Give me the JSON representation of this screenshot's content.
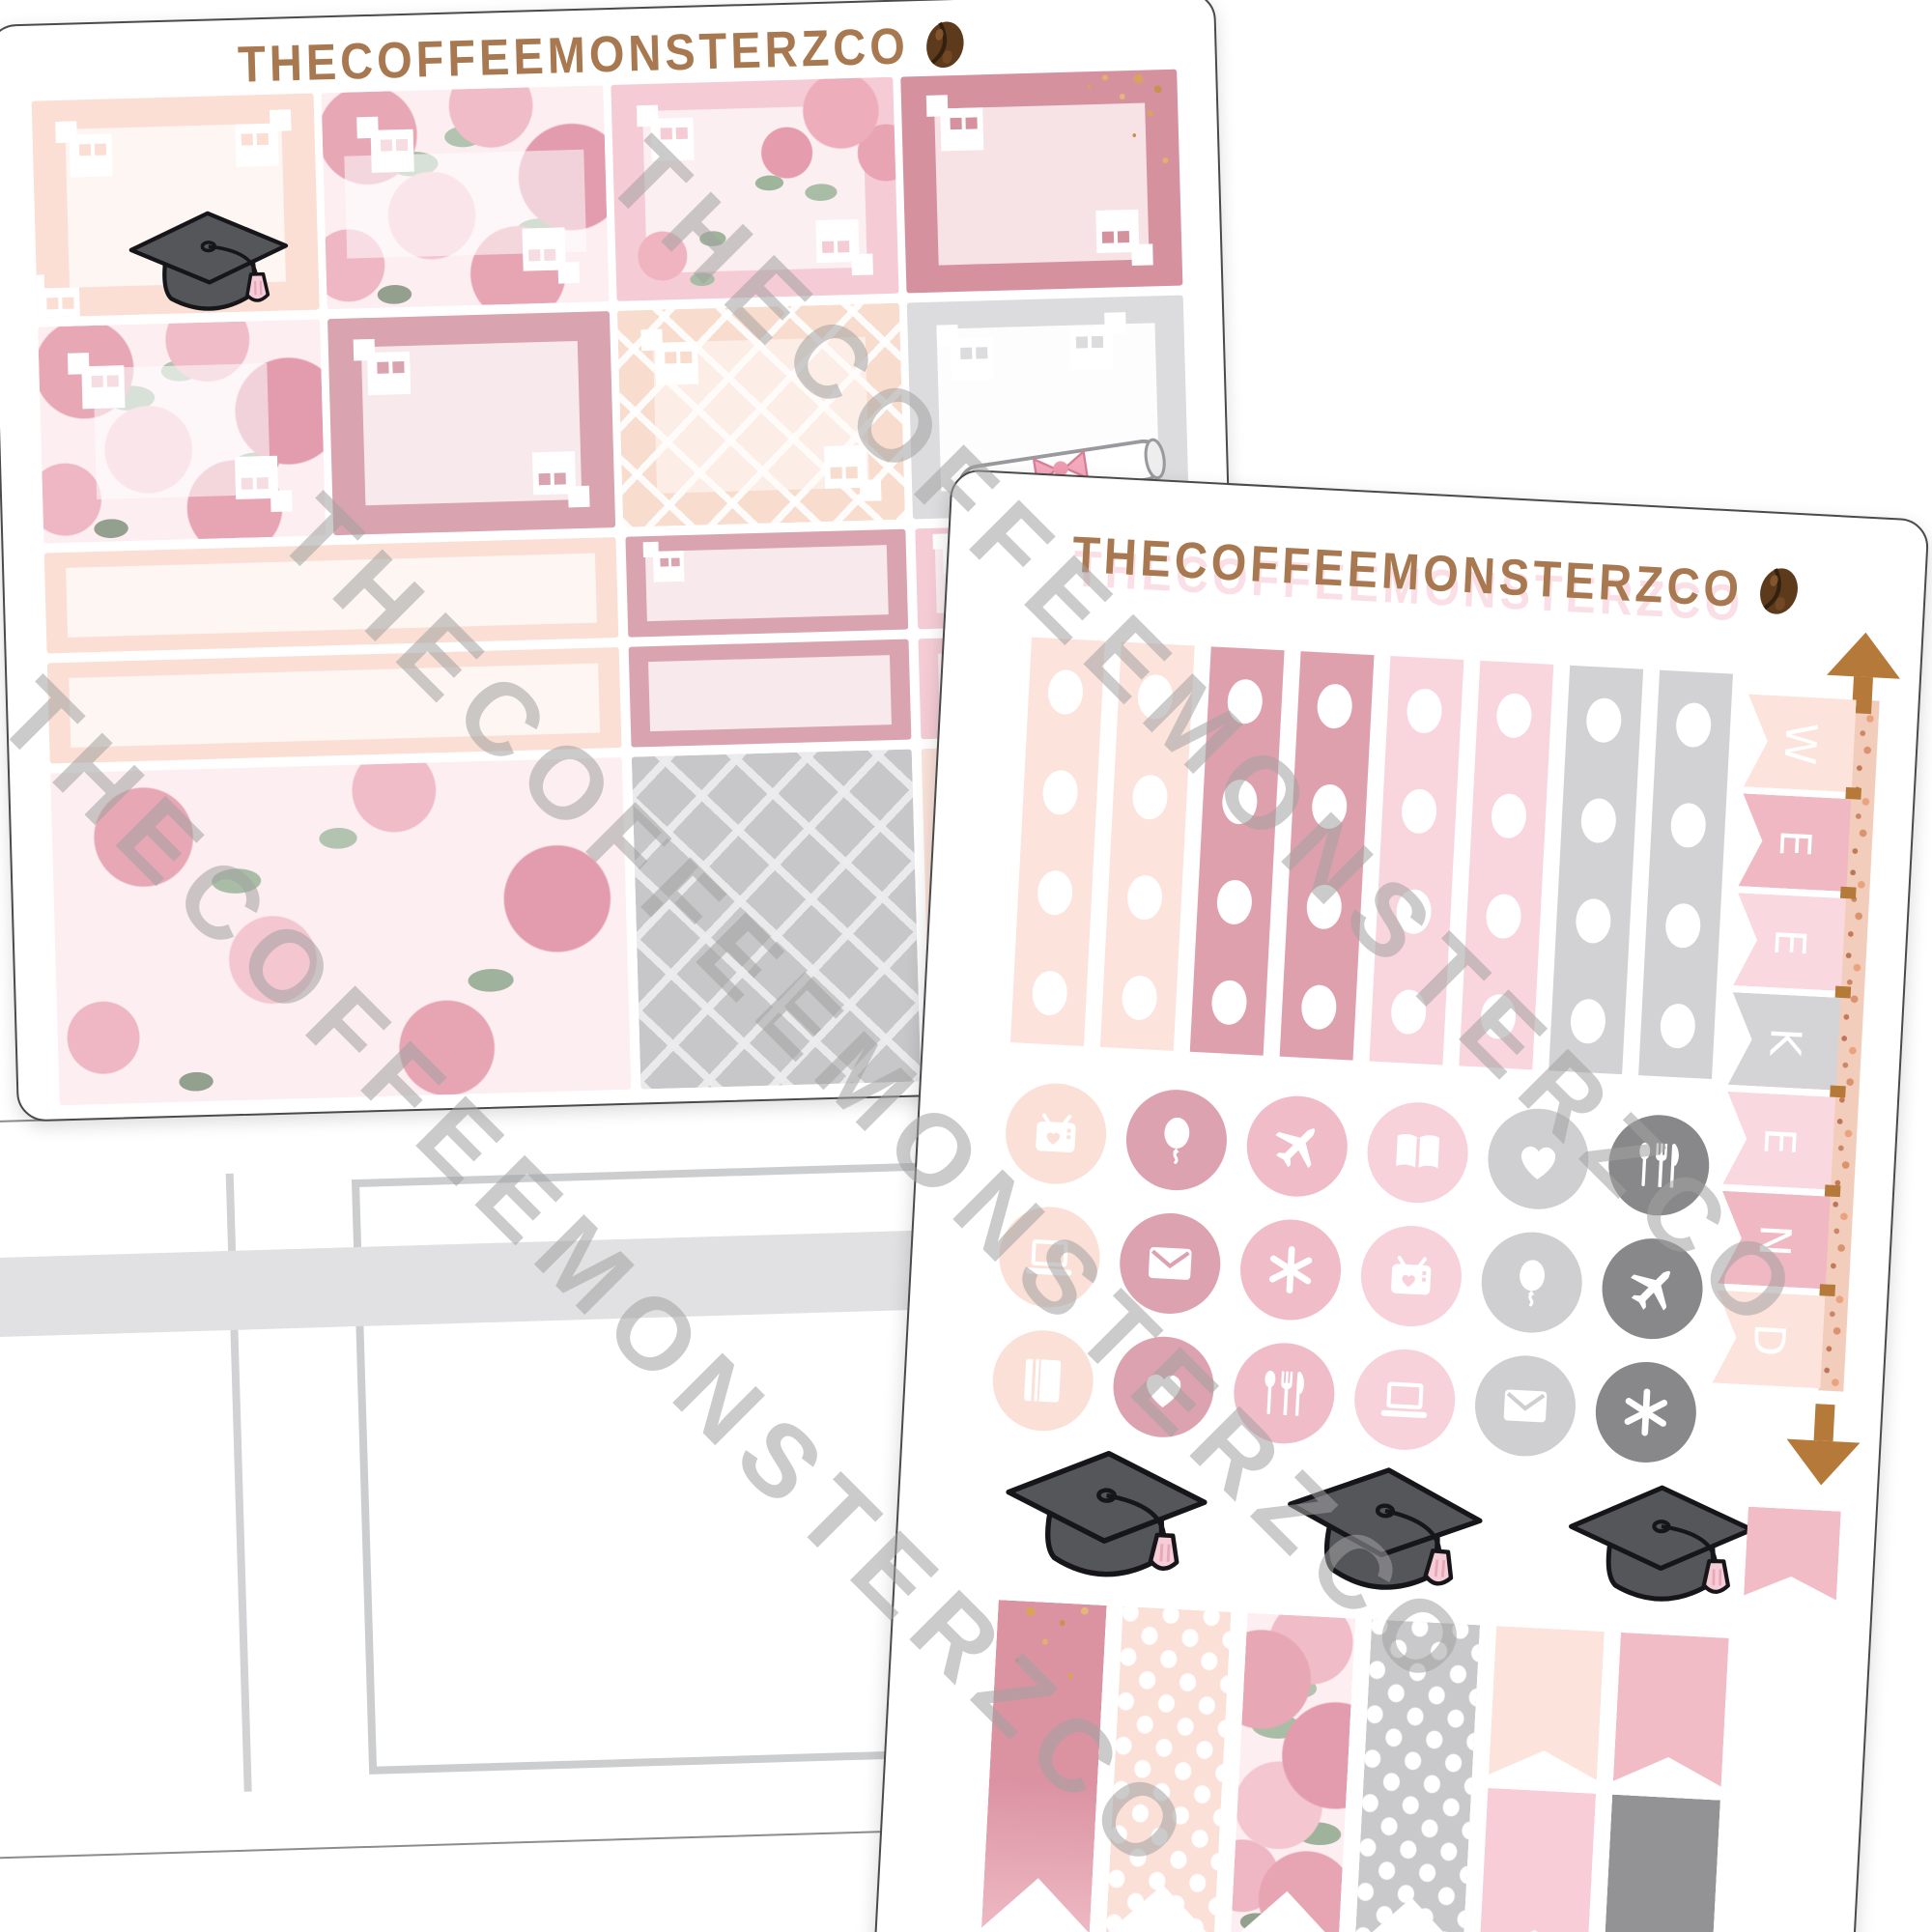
{
  "brand": {
    "name": "THECOFFEEMONSTERZCO",
    "logo_icon": "coffee-bean-icon",
    "text_color": "#a87950"
  },
  "watermark": {
    "text": "THECOFFEEMONSTERZCO",
    "color": "#a2a2a2"
  },
  "back_sheet": {
    "brand": "THECOFFEEMONSTERZCO",
    "theme": "graduation pink floral weekly kit",
    "row1_boxes": [
      "peach-border-box-with-graduation-cap",
      "floral-box-white-band",
      "pink-border-box-corner-roses",
      "rose-glitter-box"
    ],
    "row2_boxes": [
      "floral-box-white-center",
      "rose-border-box",
      "peach-lattice-box",
      "white-gray-box-with-diploma"
    ],
    "quarter_box_columns": [
      "peach-border-wide",
      "rose-border",
      "pink-border"
    ],
    "quarter_box_rows": 2,
    "bottom_boxes": [
      "floral-full-box",
      "gray-lattice-box",
      "peach-plain-box"
    ]
  },
  "front_sheet": {
    "brand": "THECOFFEEMONSTERZCO",
    "checklist_flags": {
      "dot_count": 4,
      "colors": [
        "#fce3dc",
        "#fce3dc",
        "#dfa0ad",
        "#dfa0ad",
        "#f9d6dd",
        "#f9d6dd",
        "#d2d2d4",
        "#d2d2d4"
      ]
    },
    "icon_grid": {
      "column_colors": [
        "#fbe0d8",
        "#dda2af",
        "#f0bcc8",
        "#f7d2da",
        "#cfcfd1",
        "#88888b"
      ],
      "rows": [
        [
          "tv",
          "balloon",
          "airplane",
          "book-open",
          "heart",
          "utensils"
        ],
        [
          "laptop",
          "envelope",
          "asterisk",
          "tv",
          "balloon",
          "airplane"
        ],
        [
          "book",
          "heart",
          "utensils",
          "laptop",
          "envelope",
          "asterisk"
        ]
      ]
    },
    "weekend_banner": {
      "letters": [
        "W",
        "E",
        "E",
        "K",
        "E",
        "N",
        "D"
      ],
      "flag_colors": [
        "#fce4dd",
        "#f0b8c3",
        "#f9d9df",
        "#d4d4d6",
        "#f9d9df",
        "#f0b8c3",
        "#fce4dd"
      ],
      "arrow_color": "#b5793a",
      "pole_style": "rose-gold-glitter"
    },
    "graduation_caps_count": 3,
    "bottom_flags": {
      "long_flags": [
        "rose-glitter",
        "peach-polka-dot",
        "floral",
        "gray-polka-dot"
      ],
      "stacked_flags": [
        {
          "top": "#fce4dd",
          "bottom": "#f8cdd7"
        },
        {
          "top": "#f2bcc6",
          "bottom": "#939396"
        }
      ],
      "small_flag_color": "#f2bcc6"
    }
  },
  "planner_page": {
    "description": "blank weekly planner columns",
    "band_color": "#e1e1e3"
  }
}
